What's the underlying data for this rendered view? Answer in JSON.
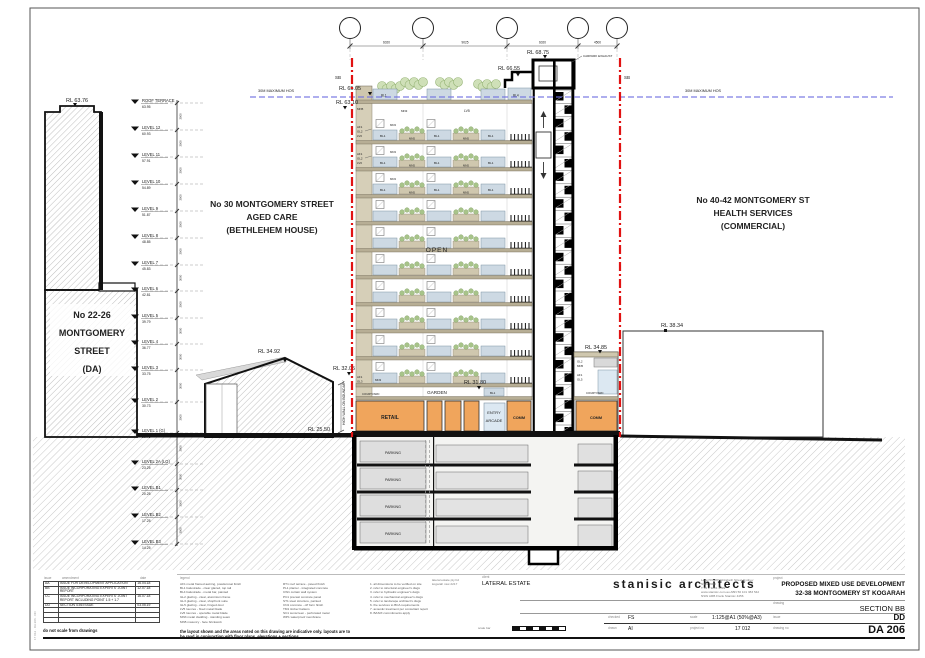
{
  "site": {
    "left": [
      "No 22-26",
      "MONTGOMERY",
      "STREET",
      "(DA)"
    ],
    "center": [
      "No 30 MONTGOMERY STREET",
      "AGED CARE",
      "(BETHLEHEM HOUSE)"
    ],
    "right": [
      "No 40-42 MONTGOMERY ST",
      "HEALTH SERVICES",
      "(COMMERCIAL)"
    ]
  },
  "rl": {
    "left_building": "RL 63.76",
    "lift_overrun": "RL 68.75",
    "core_roof": "RL 66.55",
    "tower_parapet": "RL 65.05",
    "tower_roof": "RL 63.10",
    "house_ridge": "RL 34.92",
    "podium_parapet": "RL 32.05",
    "ground_left": "RL 25.50",
    "garden_level": "RL 31.80",
    "wing_parapet": "RL 34.85",
    "wing_level": "RL 32.05",
    "ground_right": "RL 25.70",
    "right_building": "RL 38.34"
  },
  "annotations": {
    "sb": "SB",
    "max_height": "30M MAXIMUM HOS",
    "carpark_exhaust": "CARPARK EXHAUST",
    "high_wall": "HIGH WALL ON BOUNDARY",
    "open": "OPEN",
    "garden": "GARDEN",
    "retail": "RETAIL",
    "entry_line1": "ENTRY",
    "entry_line2": "ARCADE",
    "comm": "COMM",
    "parking": "PARKING",
    "courtyard": "COURTYARD"
  },
  "codes": {
    "bl1": "BL1",
    "bl4": "BL4",
    "mn5": "MN5",
    "mn3": "MN3",
    "lv5": "LV5",
    "lv6": "LV6",
    "af1": "AF1",
    "gl2": "GL2",
    "gl3": "GL3",
    "gl5": "GL5",
    "one_h": "1 H",
    "dim": "3000"
  },
  "levels": [
    {
      "name": "ROOF TERRACE",
      "rl": "63.95"
    },
    {
      "name": "LEVEL 12",
      "rl": "60.93"
    },
    {
      "name": "LEVEL 11",
      "rl": "57.91"
    },
    {
      "name": "LEVEL 10",
      "rl": "54.89"
    },
    {
      "name": "LEVEL 9",
      "rl": "51.87"
    },
    {
      "name": "LEVEL 8",
      "rl": "48.85"
    },
    {
      "name": "LEVEL 7",
      "rl": "45.83"
    },
    {
      "name": "LEVEL 6",
      "rl": "42.81"
    },
    {
      "name": "LEVEL 5",
      "rl": "39.79"
    },
    {
      "name": "LEVEL 4",
      "rl": "36.77"
    },
    {
      "name": "LEVEL 3",
      "rl": "33.75"
    },
    {
      "name": "LEVEL 2",
      "rl": "30.73"
    },
    {
      "name": "LEVEL 1 (G)",
      "rl": "26.75"
    },
    {
      "name": "LEVEL 2A (LG)",
      "rl": "23.25"
    },
    {
      "name": "LEVEL B1",
      "rl": "20.25"
    },
    {
      "name": "LEVEL B2",
      "rl": "17.25"
    },
    {
      "name": "LEVEL B3",
      "rl": "14.25"
    }
  ],
  "grid_dims": [
    "6020",
    "9025",
    "6020",
    "4500"
  ],
  "titleblock": {
    "firm_name": "stanisic architects",
    "firm_address": [
      "Level 53, 287 Elizabeth Street Sydney NSW 2000",
      "T 61 2 9281 4399",
      "www.stanisic.com.au  ABN 50 101 383 542",
      "NSW ARB Frank Stanisic 4456"
    ],
    "project_label": "project",
    "project_line1": "PROPOSED MIXED USE DEVELOPMENT",
    "project_line2": "32-38 MONTGOMERY ST KOGARAH",
    "drawing_label": "drawing",
    "drawing_value": "SECTION BB",
    "issue_label": "issue",
    "issue_value": "DD",
    "drawing_no_label": "drawing no",
    "drawing_no_value": "DA 206",
    "checked_label": "checked",
    "checked_value": "FS",
    "scale_label": "scale",
    "scale_value": "1:125@A1 (50%@A3)",
    "drawn_label": "drawn",
    "drawn_value": "AI",
    "project_no_label": "project no",
    "project_no_value": "17 012",
    "client_label": "client",
    "client_value": "LATERAL ESTATE",
    "client_note": [
      "lateral estate pty ltd",
      "kogarah nsw 2217"
    ],
    "scale_bar_label": "scale bar",
    "rev_headers": {
      "issue": "issue",
      "amendment": "amendment",
      "date": "date"
    },
    "revisions": [
      {
        "issue": "AA",
        "amendment": "ISSUE FOR DEVELOPMENT APPLICATION",
        "date": "16.04.18"
      },
      {
        "issue": "BB",
        "amendment": "ISSUE INCORPORATING EXPERTS' JOINT REPORT",
        "date": "12.07.18"
      },
      {
        "issue": "CC",
        "amendment": "ISSUE INCORPORATING EXPERTS' JOINT REPORT INCLUDING POINT 1.5 + 1.7",
        "date": "16.07.18"
      },
      {
        "issue": "DD",
        "amendment": "SECTION 4.56 ISSUE",
        "date": "03.05.19"
      }
    ],
    "no_scale_note": "do not scale from drawings",
    "indicative_note": [
      "the layout shown and the areas noted on this drawing are indicative only. layouts are to",
      "be read in conjunction with floor plans, elevations + sections."
    ],
    "legend_label": "legend",
    "legend_col1": [
      "AF1   metal framed awning, powdercoat finish",
      "BL1   balustrade - clear glazed, top rail",
      "BL4   balustrade - metal bar, painted",
      "GL2   glazing - clear, aluminium frame",
      "GL3   glazing - clear, shopfront suite",
      "GL5   glazing - clear, hinged door",
      "LV5   louvres - fixed metal blade",
      "LV6   louvres - operable metal blade",
      "MN3   metal cladding - standing seam",
      "MN5   masonry - face brickwork"
    ],
    "legend_col2": [
      "RT1   roof terrace - paved finish",
      "PL1   planter - integrated concrete",
      "CW1   curtain wall system",
      "PC1   precast concrete panel",
      "ST1   steel structure, painted",
      "CN1   concrete - off form finish",
      "TM1   timber battens",
      "SC1   sunscreen - perforated metal",
      "WP1   waterproof membrane"
    ],
    "legend_col3": [
      "1.   all dimensions to be verified on site",
      "2.   refer to structural engineer's dwgs",
      "3.   refer to hydraulic engineer's dwgs",
      "4.   refer to mechanical engineer's dwgs",
      "5.   refer to landscape architect's dwgs",
      "6.   fire services to BCA requirements",
      "7.   acoustic treatment per consultant report",
      "8.   BASIX commitments apply"
    ],
    "stamp_vertical": "17 012 · DA 206 · DD"
  },
  "colors": {
    "boundary_red": "#e11212",
    "height_blue": "#7070e0",
    "retail_orange": "#f0a55c",
    "slab_beige": "#b7ae95",
    "rail_blue": "#cdd9e3",
    "planter_green": "#8fae6e",
    "earth_gray": "#c8c8c8"
  }
}
